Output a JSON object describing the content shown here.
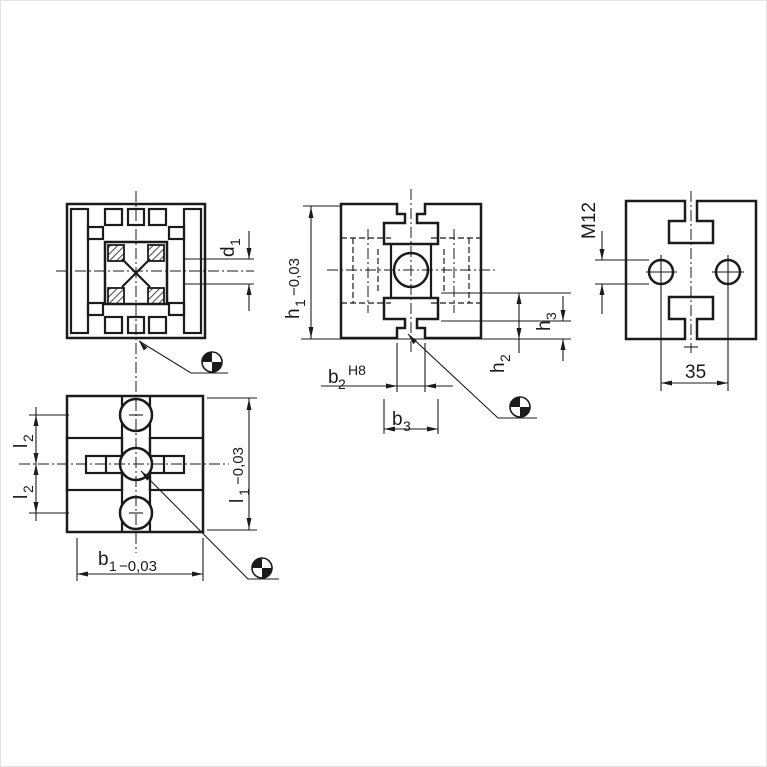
{
  "drawing": {
    "description": "Technical drawing of aluminium T-slot profile, four orthographic views with dimensions",
    "line_color": "#1b1b1b",
    "background": "#ffffff",
    "labels": {
      "d1": {
        "base": "d",
        "sub": "1"
      },
      "h1": {
        "base": "h",
        "sub": "1",
        "tol": "−0,03"
      },
      "b2": {
        "base": "b",
        "sub": "2",
        "fit": "H8"
      },
      "b3": {
        "base": "b",
        "sub": "3"
      },
      "h2": {
        "base": "h",
        "sub": "2"
      },
      "h3": {
        "base": "h",
        "sub": "3"
      },
      "m12": "M12",
      "dim35": "35",
      "l2": {
        "base": "l",
        "sub": "2"
      },
      "l1": {
        "base": "l",
        "sub": "1",
        "tol": "−0,03"
      },
      "b1": {
        "base": "b",
        "sub": "1",
        "tol": "−0,03"
      }
    },
    "views": {
      "front_section": "front section view with core bore and hatched corners",
      "side_section": "side section view with centre bore",
      "side_view_holes": "side view with two M12 tapped holes at 35 spacing",
      "bottom_view": "bottom view with three core holes"
    },
    "symbols": {
      "machining_target": "machined-surface target symbol (quadrant circle) on leader line"
    }
  }
}
